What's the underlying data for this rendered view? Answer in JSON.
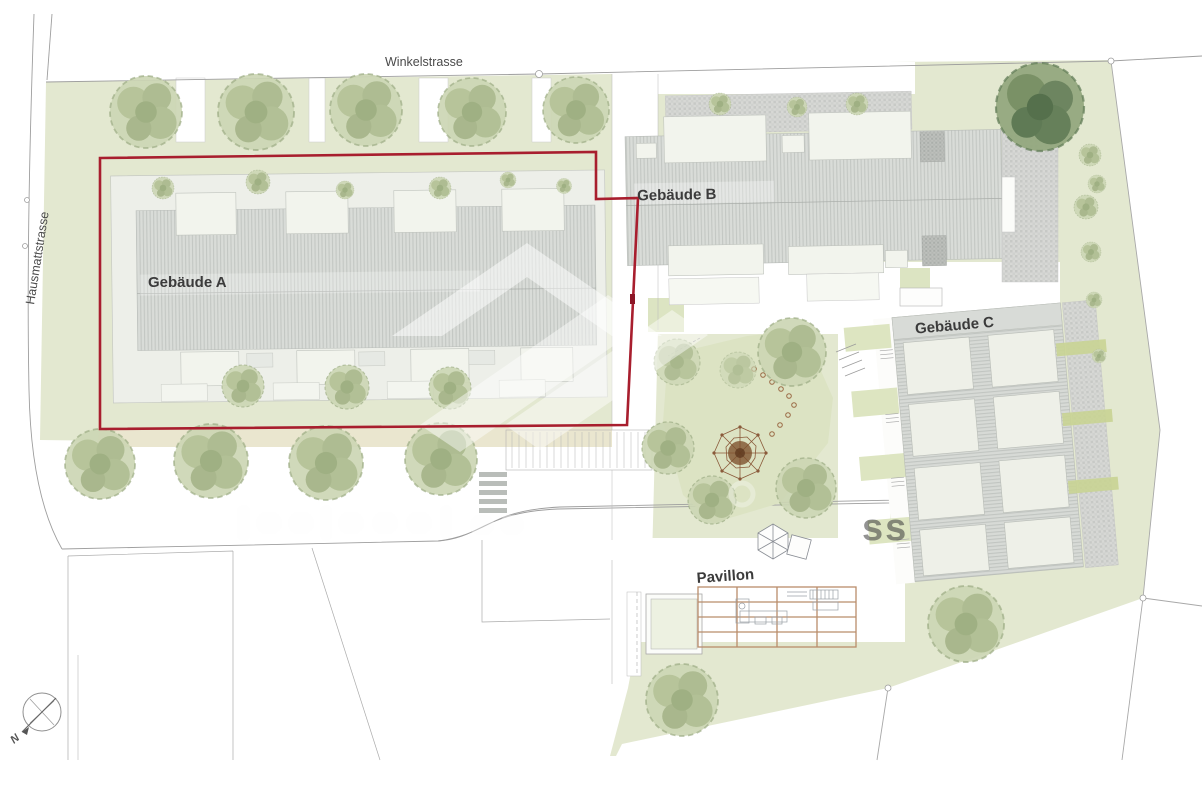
{
  "plan": {
    "streets": {
      "top": "Winkelstrasse",
      "left": "Hausmattstrasse"
    },
    "buildings": {
      "a": "Gebäude A",
      "b": "Gebäude B",
      "c": "Gebäude C"
    },
    "pavilion_label": "Pavillon",
    "compass_north": "N",
    "watermark_fragment": "ss",
    "colors": {
      "highlight_red": "#a81e2e",
      "lawn_green": "#e3e8d0",
      "courtyard_green": "#dce3c3",
      "roof_gray": "#d9dcd8",
      "tree_green": "#c6d2ae",
      "pergola_tan": "#b98d6b",
      "playground_brown": "#8a5a3a"
    }
  }
}
